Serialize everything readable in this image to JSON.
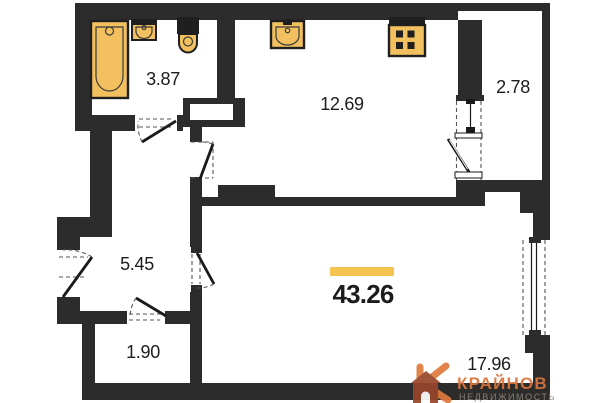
{
  "rooms": {
    "bathroom": {
      "label": "3.87"
    },
    "kitchen": {
      "label": "12.69"
    },
    "balcony": {
      "label": "2.78"
    },
    "hallway": {
      "label": "5.45"
    },
    "storage": {
      "label": "1.90"
    },
    "living": {
      "label": "17.96"
    },
    "total": {
      "label": "43.26",
      "highlighted": true
    }
  },
  "watermark": {
    "brand": "КРАЙНОВ",
    "subtitle": "НЕДВИЖИМОСТЬ"
  },
  "colors": {
    "wall": "#2c2c2c",
    "fixture_fill": "#f2c05e",
    "fixture_stroke": "#1f1f1f",
    "highlight": "#f4c351",
    "label_text": "#1c1c1c",
    "brand_orange": "#d8743c",
    "brand_house": "#97462a",
    "brand_subtitle": "#8f8477"
  },
  "icons": {
    "bathtub": "bathtub-icon",
    "bathroom_sink": "sink-icon",
    "toilet": "toilet-icon",
    "kitchen_sink": "kitchen-sink-icon",
    "stove": "stove-icon",
    "vent_shaft": "vent-shaft-icon",
    "window": "window-icon",
    "door_swing": "door-swing-icon",
    "brand_logo": "brand-k-house-icon"
  }
}
